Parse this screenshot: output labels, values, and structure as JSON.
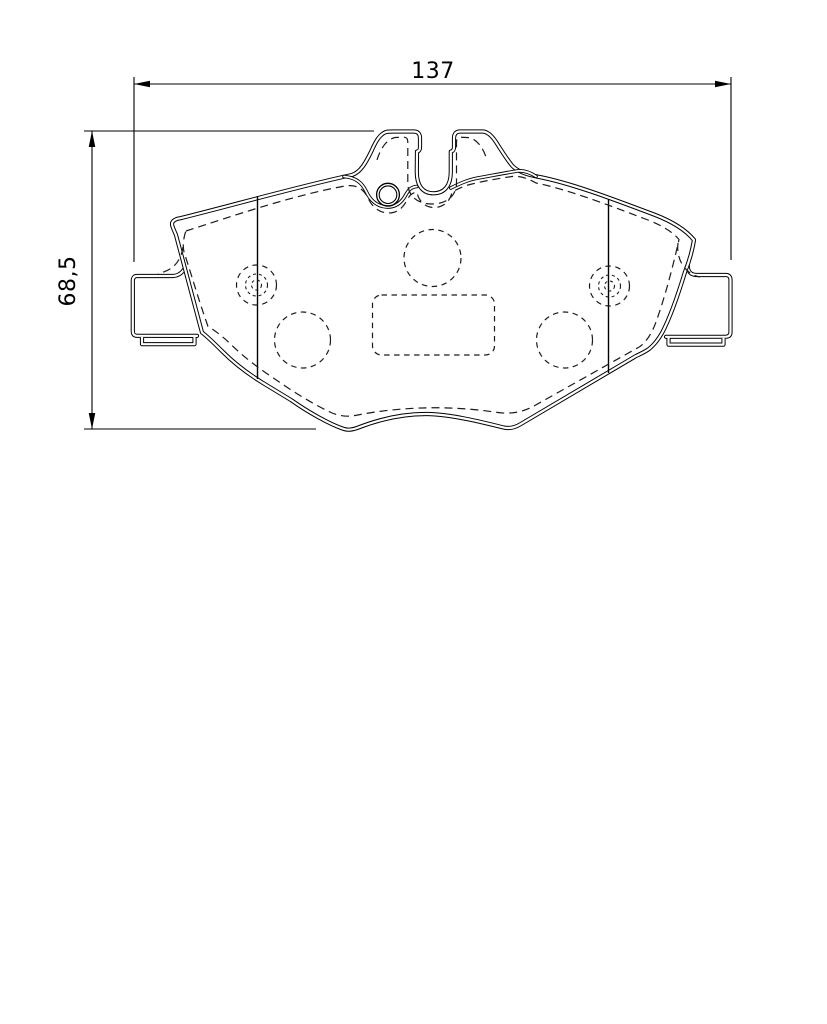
{
  "document": {
    "type": "technical-drawing",
    "subject": "brake-pad-front-outline"
  },
  "dimensions": {
    "horizontal": {
      "value": "137",
      "orientation": "horizontal"
    },
    "vertical": {
      "value": "68,5",
      "orientation": "vertical"
    }
  },
  "style": {
    "line_color": "#000000",
    "background_color": "#ffffff"
  }
}
